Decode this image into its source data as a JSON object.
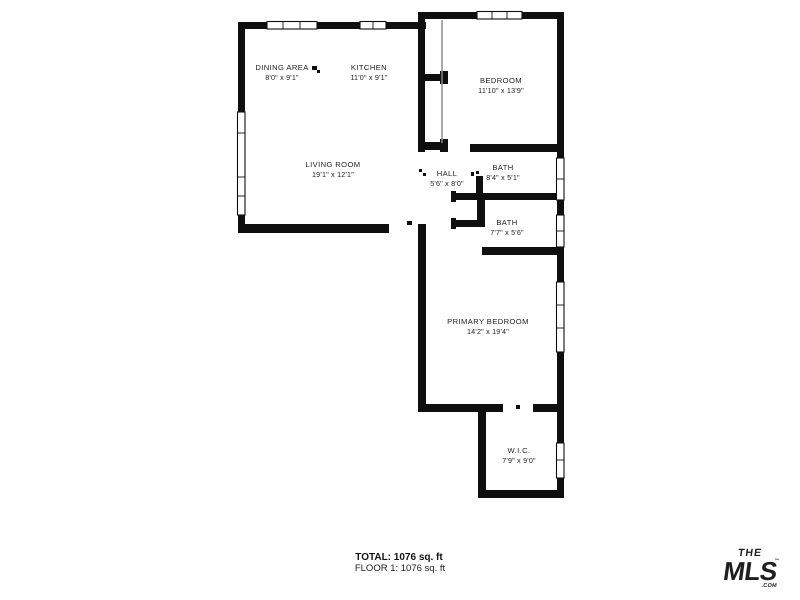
{
  "page": {
    "background": "#ffffff",
    "wall_color": "#0f0f0f"
  },
  "floorplan": {
    "rooms": [
      {
        "name": "DINING AREA",
        "dims": "8'0\" x 9'1\""
      },
      {
        "name": "KITCHEN",
        "dims": "11'0\" x 9'1\""
      },
      {
        "name": "BEDROOM",
        "dims": "11'10\" x 13'9\""
      },
      {
        "name": "LIVING ROOM",
        "dims": "19'1\" x 12'1\""
      },
      {
        "name": "HALL",
        "dims": "5'6\" x 8'0\""
      },
      {
        "name": "BATH",
        "dims": "8'4\" x 5'1\""
      },
      {
        "name": "BATH",
        "dims": "7'7\" x 5'6\""
      },
      {
        "name": "PRIMARY BEDROOM",
        "dims": "14'2\" x 19'4\""
      },
      {
        "name": "W.I.C.",
        "dims": "7'9\" x 9'0\""
      }
    ]
  },
  "footer": {
    "total": "TOTAL: 1076 sq. ft",
    "floor": "FLOOR 1: 1076 sq. ft"
  },
  "logo": {
    "the": "THE",
    "mls": "MLS",
    "tm": "™",
    "com": ".COM",
    "color": "#e23a3c"
  }
}
